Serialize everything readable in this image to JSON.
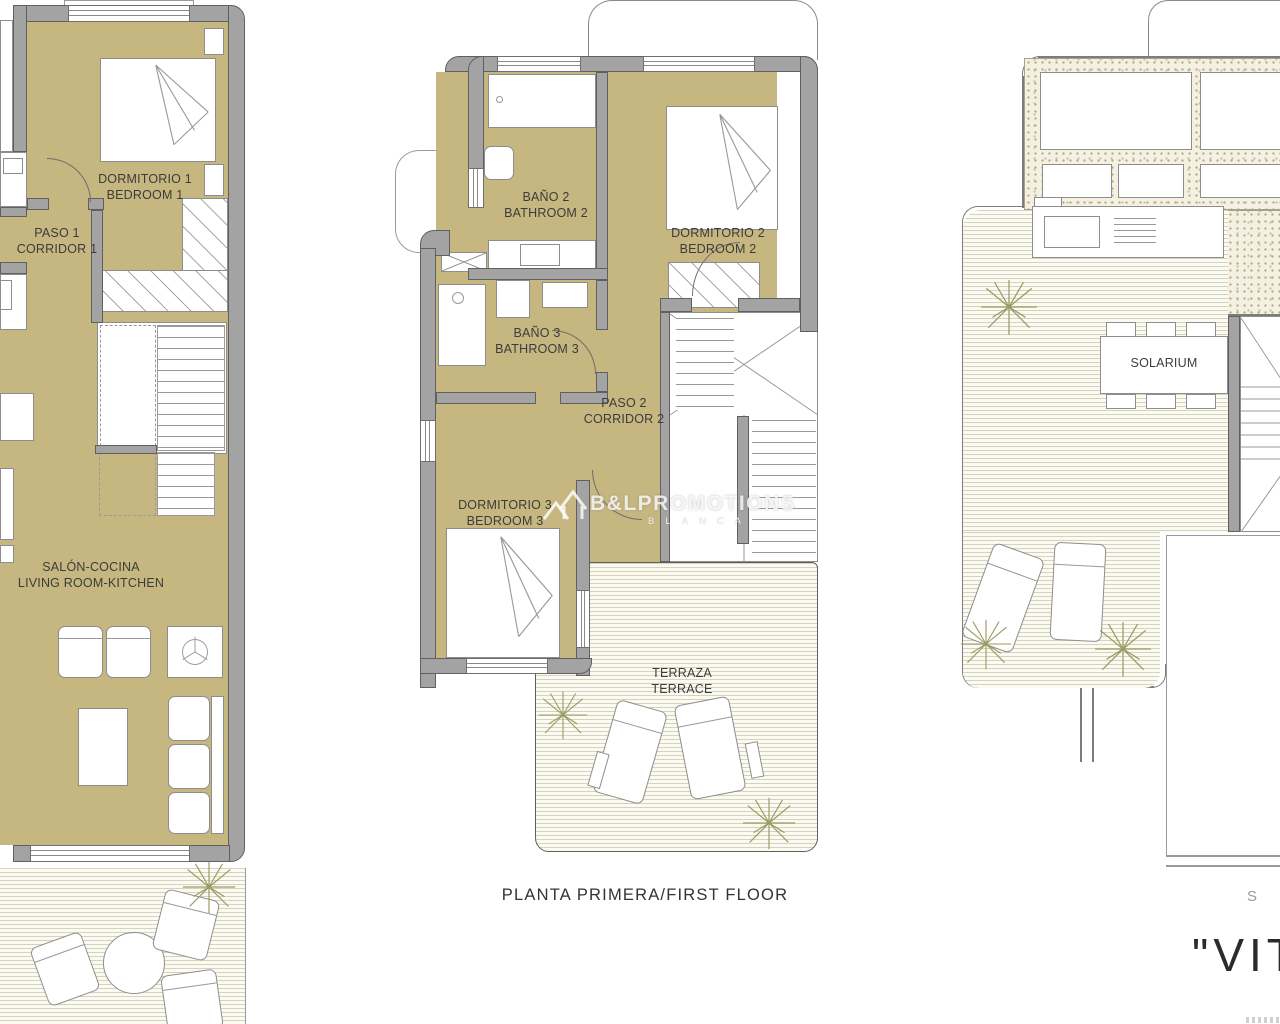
{
  "watermark": {
    "logo_icon": "house-roofs-icon",
    "brand": "B&LPROMOTIONS",
    "subtitle": "BLANCA"
  },
  "floors": {
    "ground": {
      "bedroom1_es": "DORMITORIO 1",
      "bedroom1_en": "BEDROOM 1",
      "corridor1_es": "PASO 1",
      "corridor1_en": "CORRIDOR 1",
      "living_es": "SALÓN-COCINA",
      "living_en": "LIVING ROOM-KITCHEN"
    },
    "first": {
      "caption": "PLANTA PRIMERA/FIRST FLOOR",
      "bathroom2_es": "BAÑO 2",
      "bathroom2_en": "BATHROOM 2",
      "bedroom2_es": "DORMITORIO 2",
      "bedroom2_en": "BEDROOM 2",
      "bathroom3_es": "BAÑO 3",
      "bathroom3_en": "BATHROOM 3",
      "corridor2_es": "PASO 2",
      "corridor2_en": "CORRIDOR 2",
      "bedroom3_es": "DORMITORIO 3",
      "bedroom3_en": "BEDROOM 3",
      "terrace_es": "TERRAZA",
      "terrace_en": "TERRACE"
    },
    "solarium": {
      "solarium_label": "SOLARIUM",
      "caption_partial": "S"
    }
  },
  "title_partial": "\"VIT",
  "colors": {
    "room_fill": "#c6b67f",
    "wall": "#a3a3a3",
    "deck_line": "#94926c",
    "stipple": "#b7ad8e",
    "plant": "#9a9a62",
    "label_text": "#3c3c3c"
  }
}
